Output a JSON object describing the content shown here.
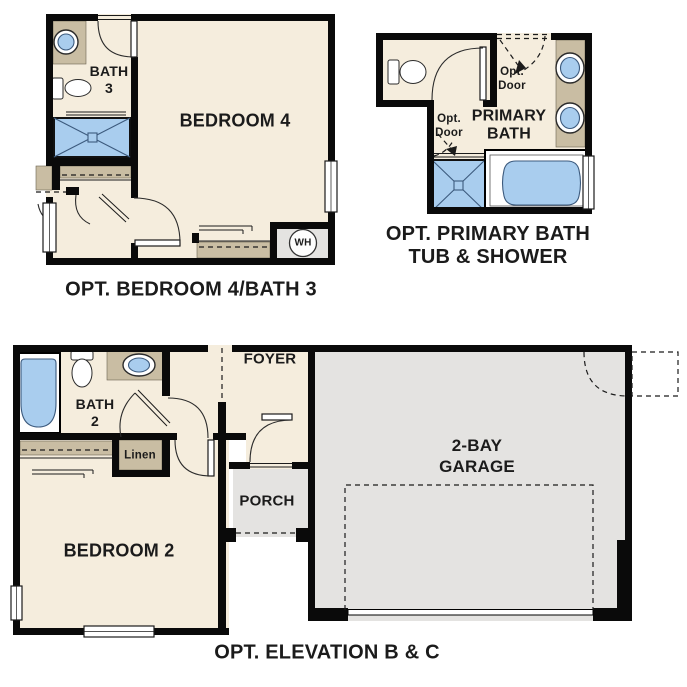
{
  "colors": {
    "bg": "#ffffff",
    "wall": "#0a0a0a",
    "floor": "#f5eddd",
    "counter": "#c9bda3",
    "fixture": "#a9cdee",
    "fixture-line": "#3c5a7d",
    "concrete": "#e4e3e1",
    "label": "#1b1b1b"
  },
  "plans": [
    {
      "id": "opt-bedroom4-bath3",
      "caption": "OPT. BEDROOM 4/BATH 3",
      "labels": {
        "bedroom": "BEDROOM 4",
        "bath": [
          "BATH",
          "3"
        ],
        "water_heater": "WH"
      }
    },
    {
      "id": "opt-primary-bath",
      "caption": [
        "OPT. PRIMARY BATH",
        "TUB & SHOWER"
      ],
      "labels": {
        "room": [
          "PRIMARY",
          "BATH"
        ],
        "opt_door_top": [
          "Opt.",
          "Door"
        ],
        "opt_door_side": [
          "Opt.",
          "Door"
        ]
      }
    },
    {
      "id": "opt-elevation-bc",
      "caption": "OPT. ELEVATION B & C",
      "labels": {
        "bedroom": "BEDROOM 2",
        "bath": [
          "BATH",
          "2"
        ],
        "linen": "Linen",
        "foyer": "FOYER",
        "porch": "PORCH",
        "garage": [
          "2-BAY",
          "GARAGE"
        ]
      }
    }
  ]
}
